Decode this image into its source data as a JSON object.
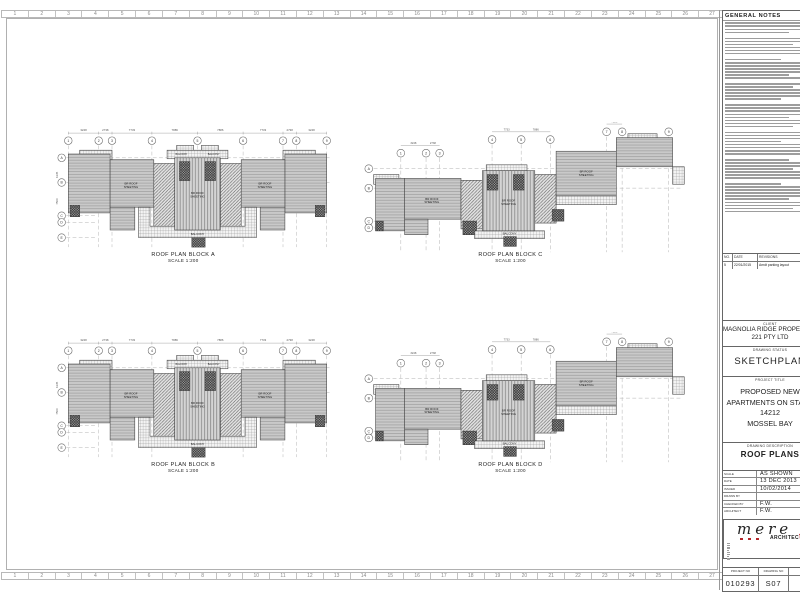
{
  "sheet": {
    "ruler_numbers": [
      "1",
      "2",
      "3",
      "4",
      "5",
      "6",
      "7",
      "8",
      "9",
      "10",
      "11",
      "12",
      "13",
      "14",
      "15",
      "16",
      "17",
      "18",
      "19",
      "20",
      "21",
      "22",
      "23",
      "24",
      "25",
      "26",
      "27"
    ]
  },
  "plans": [
    {
      "id": "A",
      "title": "ROOF PLAN BLOCK A",
      "scale": "SCALE 1:200",
      "variant": "symmetric"
    },
    {
      "id": "C",
      "title": "ROOF PLAN BLOCK C",
      "scale": "SCALE 1:200",
      "variant": "stepped"
    },
    {
      "id": "B",
      "title": "ROOF PLAN BLOCK B",
      "scale": "SCALE 1:200",
      "variant": "symmetric"
    },
    {
      "id": "D",
      "title": "ROOF PLAN BLOCK D",
      "scale": "SCALE 1:200",
      "variant": "stepped"
    }
  ],
  "plan_annotations": {
    "column_bubbles": [
      "1",
      "2",
      "3",
      "4",
      "5",
      "6",
      "7",
      "8",
      "9"
    ],
    "row_bubbles": [
      "A",
      "B",
      "C",
      "D",
      "E"
    ],
    "top_dimensions": [
      "3248",
      "2738",
      "7733",
      "7886",
      "7886",
      "7733",
      "2738",
      "3248"
    ],
    "side_dimensions": [
      "6135",
      "7500"
    ],
    "roof_label_lines": [
      "BR ROOF",
      "SHEETING"
    ],
    "balcony_label": "BALCONY"
  },
  "title_block": {
    "general_notes_title": "GENERAL NOTES",
    "revisions": {
      "headers": [
        "NO.",
        "DATE",
        "REVISIONS"
      ],
      "rows": [
        [
          "5",
          "22/01/2015",
          "Amdt parking layout"
        ]
      ]
    },
    "client_label": "CLIENT",
    "client_lines": [
      "MAGNOLIA RIDGE PROPERTIES",
      "221 PTY LTD"
    ],
    "drawing_status_label": "DRAWING STATUS",
    "drawing_status": "SKETCHPLAN",
    "project_title_label": "PROJECT TITLE",
    "project_title_lines": [
      "PROPOSED NEW",
      "APARTMENTS ON STAND",
      "14212",
      "MOSSEL BAY"
    ],
    "drawing_description_label": "DRAWING DESCRIPTION",
    "drawing_description": "ROOF PLANS",
    "info_rows": [
      [
        "SCALE",
        "AS SHOWN"
      ],
      [
        "DATE",
        "13 DEC 2013"
      ],
      [
        "ISSUED",
        "10/02/2014"
      ],
      [
        "DRAWN BY",
        ""
      ],
      [
        "CHECKED BY",
        "F.W."
      ],
      [
        "ARCHITECT",
        "F.W."
      ]
    ],
    "logo_text": "mere",
    "logo_sub_prefix": "ARCHITEC",
    "logo_sub_accent": "t",
    "logo_sub_suffix": "URE",
    "footer": {
      "headers": [
        "PROJECT NO",
        "DRAWING NO",
        "REV"
      ],
      "values": [
        "010293",
        "S07",
        ""
      ]
    }
  },
  "colors": {
    "accent_red": "#b5252a",
    "line_gray": "#9a9a9a",
    "roof_fill": "#c9c9c9"
  }
}
